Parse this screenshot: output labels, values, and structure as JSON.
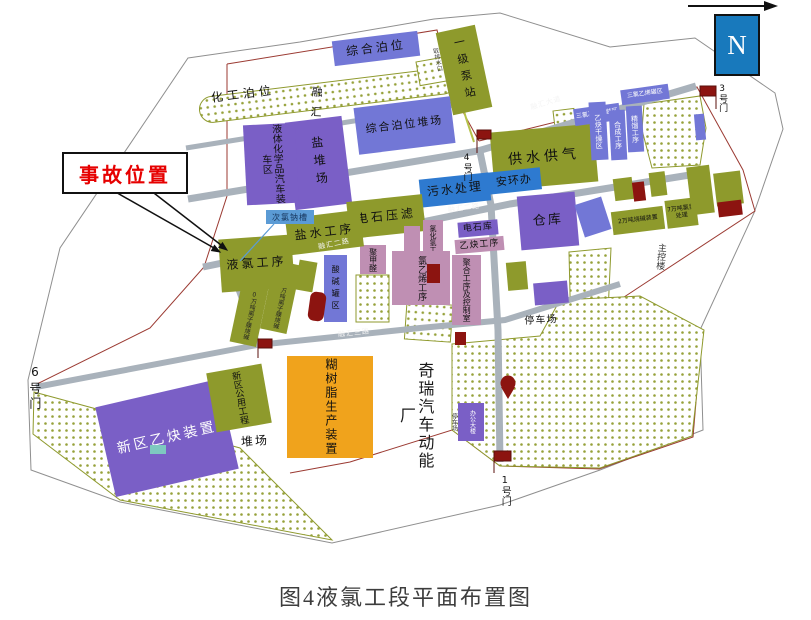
{
  "figure": {
    "caption": "图4液氯工段平面布置图"
  },
  "compass": {
    "letter": "N"
  },
  "callout": {
    "accident_label": "事故位置"
  },
  "gates": {
    "g1": "1号门",
    "g3": "3号门",
    "g4": "4号门",
    "g6": "6号门"
  },
  "roads": {
    "main_avenue": "融汇大道",
    "road2": "融汇二路",
    "road2b": "融汇二路",
    "road3": "融汇三路"
  },
  "port": {
    "chemical_berth": "化工泊位",
    "wharf": "融汇化工码头",
    "general_berth": "综合泊位",
    "pump_station": "一级泵站",
    "water_intake": "取排水口",
    "salt_yard": "盐堆场",
    "berth_yard": "综合泊位堆场",
    "truck_loading": "液体化学品汽车装车区"
  },
  "plant": {
    "water_gas": "供水供气",
    "sewage": "污水处理",
    "safety_office": "安环办",
    "tce_packing": "三氯乙烯包装区",
    "tce_tanks": "三氯乙烯罐区",
    "acetylene_drying": "乙炔干燥区",
    "synthesis": "合成工序",
    "distillation": "精馏工序",
    "caustic_20k": "2万吨烧碱装置",
    "chlor_hydrogen_70k": "7万吨氯氢处理",
    "main_control": "主控楼",
    "warehouse": "仓库",
    "parking_a": "停车场",
    "parking_b": "停车场",
    "carbide_press": "电石压滤",
    "carbide_store": "电石库",
    "acetylene": "乙炔工序",
    "hcl": "氯化氢工序",
    "vcm": "氯乙烯工序",
    "polymer": "聚合工序及控制室",
    "pom": "聚甲醛",
    "acid_alkali_tanks": "酸碱罐区",
    "membrane_a": "1.0万吨离子膜烧碱",
    "membrane_b": "1.0万吨离子膜烧碱",
    "brine": "盐水工序",
    "liquid_chlorine": "液氯工序",
    "hypochlorite_tank": "次氯钠槽"
  },
  "south": {
    "new_acetylene": "新区乙炔装置",
    "new_utilities": "新区公用工程",
    "stock_yard": "堆场",
    "paste_resin": "糊树脂生产装置",
    "chery": "奇瑞汽车动能厂",
    "office": "办公大楼"
  },
  "colors": {
    "purple": "#7a5fc6",
    "blue_purple": "#7277d6",
    "olive": "#8e9a2c",
    "blue": "#2e7ad0",
    "pink": "#bf8fb3",
    "orange": "#f0a31c",
    "dark_red": "#8c1410",
    "road_gray": "#a9b2bb",
    "accent_red": "#e60000",
    "compass_blue": "#1879bc",
    "tag_blue": "#5b9bd5"
  }
}
